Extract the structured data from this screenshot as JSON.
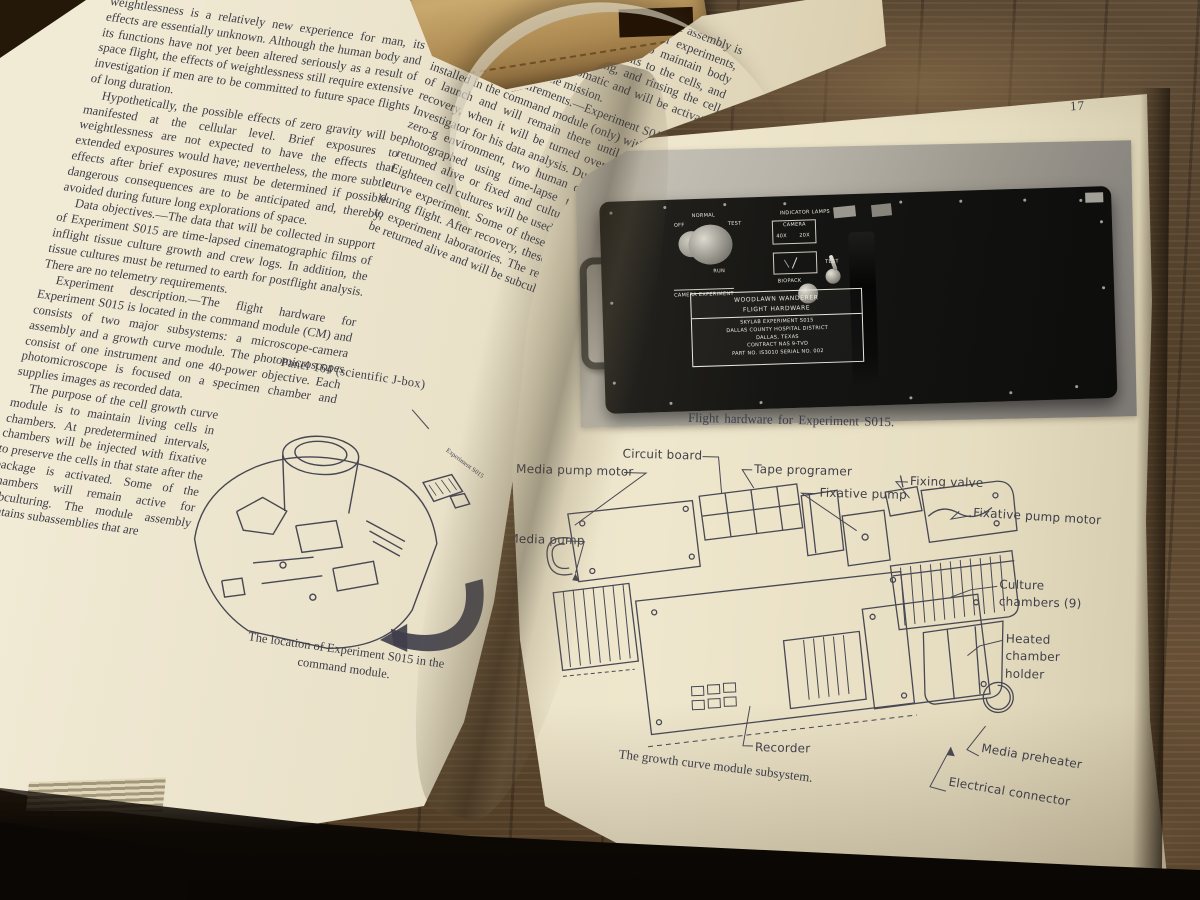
{
  "book": {
    "left_page": {
      "column1": [
        "weightlessness is a relatively new experience for man, its effects are essentially unknown. Although the human body and its functions have not yet been altered seriously as a result of space flight, the effects of weightlessness still require extensive investigation if men are to be committed to future space flights of long duration.",
        "Hypothetically, the possible effects of zero gravity will be manifested at the cellular level. Brief exposures to weightlessness are not expected to have the effects that extended exposures would have; nevertheless, the more subtle effects after brief exposures must be determined if possible dangerous consequences are to be anticipated and, thereby, avoided during future long explorations of space.",
        "Data objectives.—The data that will be collected in support of Experiment S015 are time-lapsed cinematographic films of inflight tissue culture growth and crew logs. In addition, the tissue cultures must be returned to earth for postflight analysis. There are no telemetry requirements.",
        "Experiment description.—The flight hardware for Experiment S015 is located in the command module (CM) and consists of two major subsystems: a microscope-camera assembly and a growth curve module. The photomicroscopes consist of one instrument and one 40-power objective. Each photomicroscope is focused on a specimen chamber and supplies images as recorded data.",
        "The purpose of the cell growth curve module is to maintain living cells in chambers. At predetermined intervals, chambers will be injected with fixative to preserve the cells in that state after the package is activated. Some of the chambers will remain active for subculturing. The module assembly contains subassemblies that are"
      ],
      "column2": [
        "enclosed in a common sealed container. The assembly is capable of performing several chemical experiments, and it contains nine cell chambers to maintain body temperature, providing fresh nutrients to the cells, and the capability for labeling, fixing, and rinsing the cell cultures. The system is automatic and will be activated on the ground prior to the mission.",
        "Operational requirements.—Experiment S015 will be installed in the command module (only) within 13 hours of launch and will remain there until removal after recovery, when it will be turned over to the Principal Investigator for his data analysis. During exposure to the zero-g environment, two human cell cultures will be photographed using time-lapse techniques and then returned alive or fixed and cultured for further study. Eighteen cell cultures will be used to perform the growth curve experiment. Some of these cultures will be fixed during flight. After recovery, these cultures will be sent to experiment laboratories. The remaining cultures will be returned alive and will be subcultured."
      ],
      "panel_label": "Panel 164 (scientific J-box)",
      "inset_label": "Experiment S015",
      "figure_caption": "The location of Experiment S015 in the command module."
    },
    "right_page": {
      "page_number": "17",
      "photo": {
        "knob_labels": {
          "normal": "NORMAL",
          "off": "OFF",
          "test": "TEST",
          "run": "RUN",
          "camera_experiment": "CAMERA EXPERIMENT"
        },
        "lamp_labels": {
          "indicator_lamps": "INDICATOR LAMPS",
          "camera": "CAMERA",
          "mag_40": "40X",
          "mag_20": "20X",
          "biopack": "BIOPACK",
          "test": "TEST",
          "pow": "POW"
        },
        "nameplate": [
          "WOODLAWN WANDERER",
          "FLIGHT HARDWARE",
          "SKYLAB EXPERIMENT S015",
          "DALLAS COUNTY HOSPITAL DISTRICT",
          "DALLAS, TEXAS",
          "CONTRACT NAS 9-TVD",
          "PART NO. IS3010   SERIAL NO. 002"
        ],
        "caption": "Flight hardware for Experiment S015."
      },
      "diagram": {
        "labels": [
          "Media pump motor",
          "Circuit board",
          "Tape programer",
          "Fixative pump",
          "Fixing valve",
          "Fixative pump motor",
          "Media pump",
          "Culture chambers (9)",
          "Heated chamber holder",
          "Recorder",
          "Media preheater",
          "Electrical connector"
        ],
        "caption": "The growth curve module subsystem."
      }
    }
  }
}
